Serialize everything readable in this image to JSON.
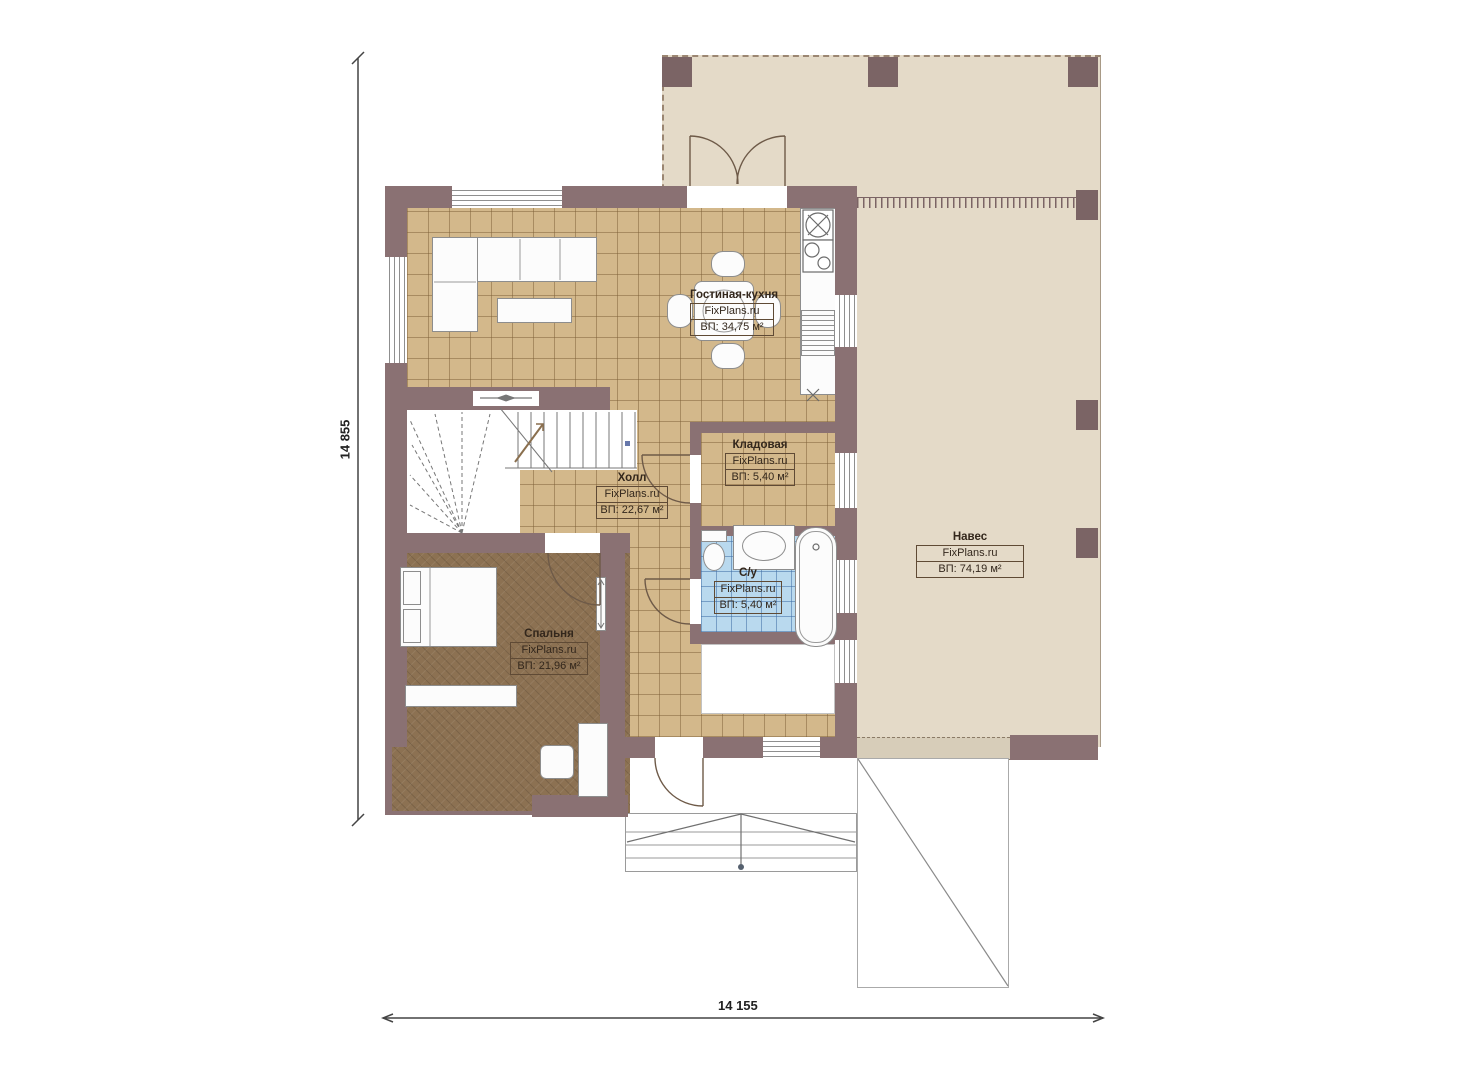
{
  "plan": {
    "brand": "FixPlans.ru",
    "rooms": [
      {
        "id": "living-kitchen",
        "name": "Гостиная-кухня",
        "area": "ВП: 34,75 м²"
      },
      {
        "id": "storage",
        "name": "Кладовая",
        "area": "ВП: 5,40 м²"
      },
      {
        "id": "hall",
        "name": "Холл",
        "area": "ВП: 22,67 м²"
      },
      {
        "id": "bathroom",
        "name": "С/у",
        "area": "ВП: 5,40 м²"
      },
      {
        "id": "bedroom",
        "name": "Спальня",
        "area": "ВП: 21,96 м²"
      },
      {
        "id": "canopy",
        "name": "Навес",
        "area": "ВП: 74,19 м²"
      }
    ],
    "dimensions": {
      "height_label": "14 855",
      "width_label": "14 155"
    },
    "colors": {
      "wall": "#8a7173",
      "post": "#7b6465",
      "tile_floor": "#d3b88b",
      "bedroom_floor": "#8c7152",
      "bathroom_tile": "#b9d9ee",
      "canopy_fill": "#e4dac8"
    }
  }
}
